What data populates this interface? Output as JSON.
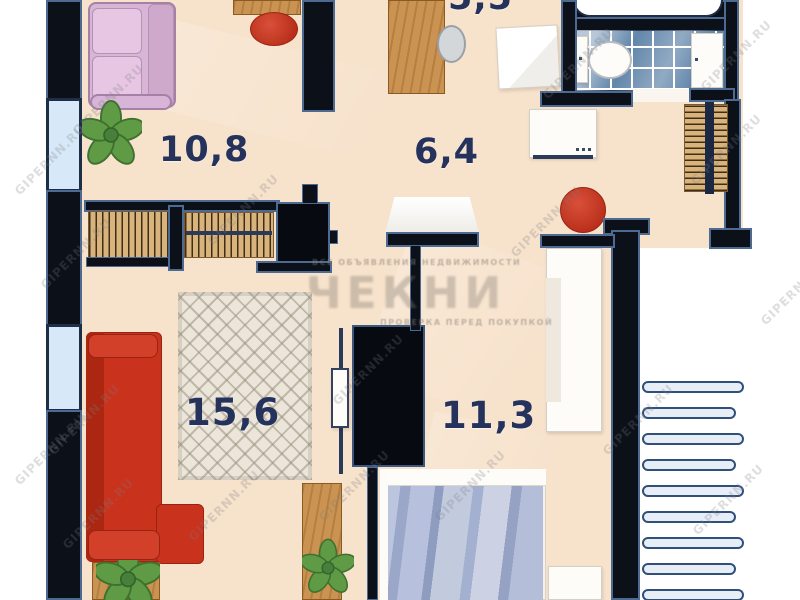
{
  "plan_type": "apartment-floor-plan",
  "rooms": {
    "kitchen": {
      "label": "5,5"
    },
    "top_left_room": {
      "label": "10,8"
    },
    "hallway": {
      "label": "6,4"
    },
    "living_room": {
      "label": "15,6"
    },
    "bedroom": {
      "label": "11,3"
    }
  },
  "watermarks": {
    "diagonal_text": "GIPERNN.RU",
    "center_title": "ЧЕКНИ",
    "center_top_line": "ВСЕ ОБЪЯВЛЕНИЯ НЕДВИЖИМОСТИ",
    "center_bottom_line": "ПРОВЕРКА ПЕРЕД ПОКУПКОЙ"
  },
  "staircase": {
    "bar_count": 9
  },
  "furniture_icons": [
    "pink-sofa",
    "desk",
    "office-chair",
    "potted-plant",
    "coat-rack",
    "wardrobe-cabinet",
    "kitchen-counter",
    "kitchen-sink",
    "stove-table",
    "bathtub",
    "toilet",
    "bathroom-sink",
    "washing-machine",
    "hanger-rack",
    "red-stool",
    "console-table",
    "area-rug",
    "red-corner-sofa",
    "tv",
    "built-in-wardrobe",
    "side-desk",
    "coffee-table",
    "white-wardrobe",
    "double-bed",
    "nightstand",
    "exterior-staircase",
    "window"
  ],
  "colors": {
    "floor": "#f7e2cb",
    "wall": "#0b1019",
    "wall_outline": "#4d6a92",
    "window_glass": "#d7e9f8",
    "accent_red": "#c9331d",
    "wood": "#cb9352",
    "plant_green": "#5f9a45",
    "rug": "#ece6da",
    "bathroom_tile": "#6286aa",
    "blanket_blue": "#aab6d4",
    "label_text": "#24325c",
    "watermark_grey": "#8a8178"
  }
}
